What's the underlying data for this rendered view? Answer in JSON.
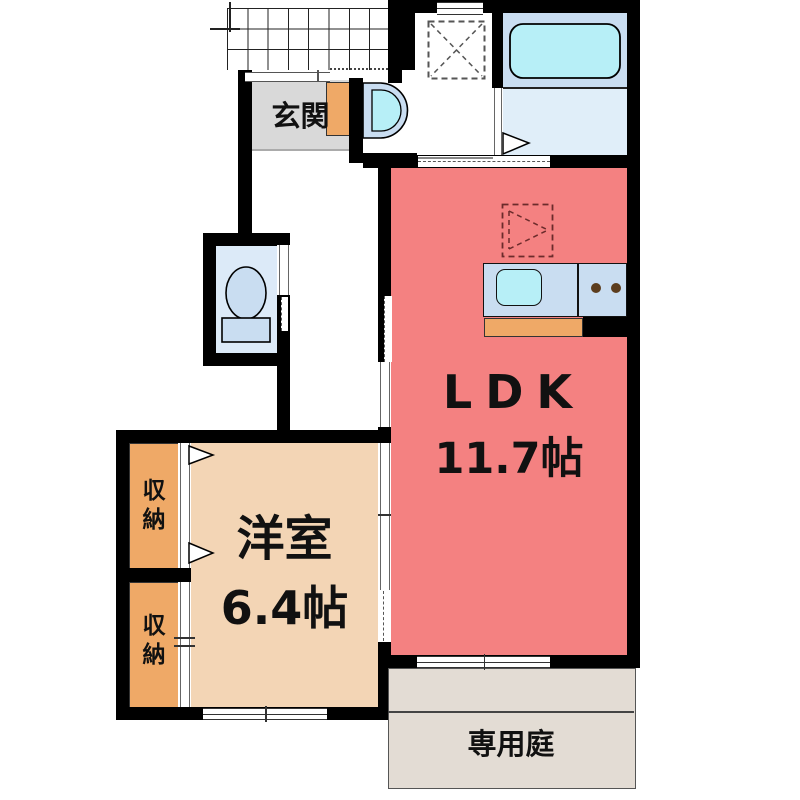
{
  "plan_title": "1LDK apartment floor plan",
  "rooms": {
    "genkan": {
      "label": "玄関"
    },
    "ldk": {
      "label": "LDK",
      "size": "11.7帖"
    },
    "western_room": {
      "label": "洋室",
      "size": "6.4帖"
    },
    "closet_upper": {
      "label": "収納"
    },
    "closet_lower": {
      "label": "収納"
    },
    "garden": {
      "label": "専用庭"
    }
  },
  "fixtures": {
    "washing_machine": "washing-machine-space",
    "bathtub": "bathtub",
    "washbasin": "washbasin",
    "toilet": "toilet",
    "refrigerator": "refrigerator-space",
    "kitchen_sink": "kitchen-sink",
    "stove": "two-burner-stove"
  },
  "colors": {
    "ldk_floor": "#F48181",
    "western_room_floor": "#F3D5B5",
    "closet": "#EFA967",
    "shoe_cabinet": "#EFA967",
    "counter_front": "#EFA967",
    "genkan_floor": "#D9D9D9",
    "garden": "#E3DCD4",
    "water_fixture_body": "#C9DDF1",
    "water_inner": "#B7EFF7",
    "bathroom_floor": "#E0EEF9",
    "toilet_floor": "#DCEAF8",
    "wall": "#000000",
    "stove_burner": "#5C3D1E"
  }
}
